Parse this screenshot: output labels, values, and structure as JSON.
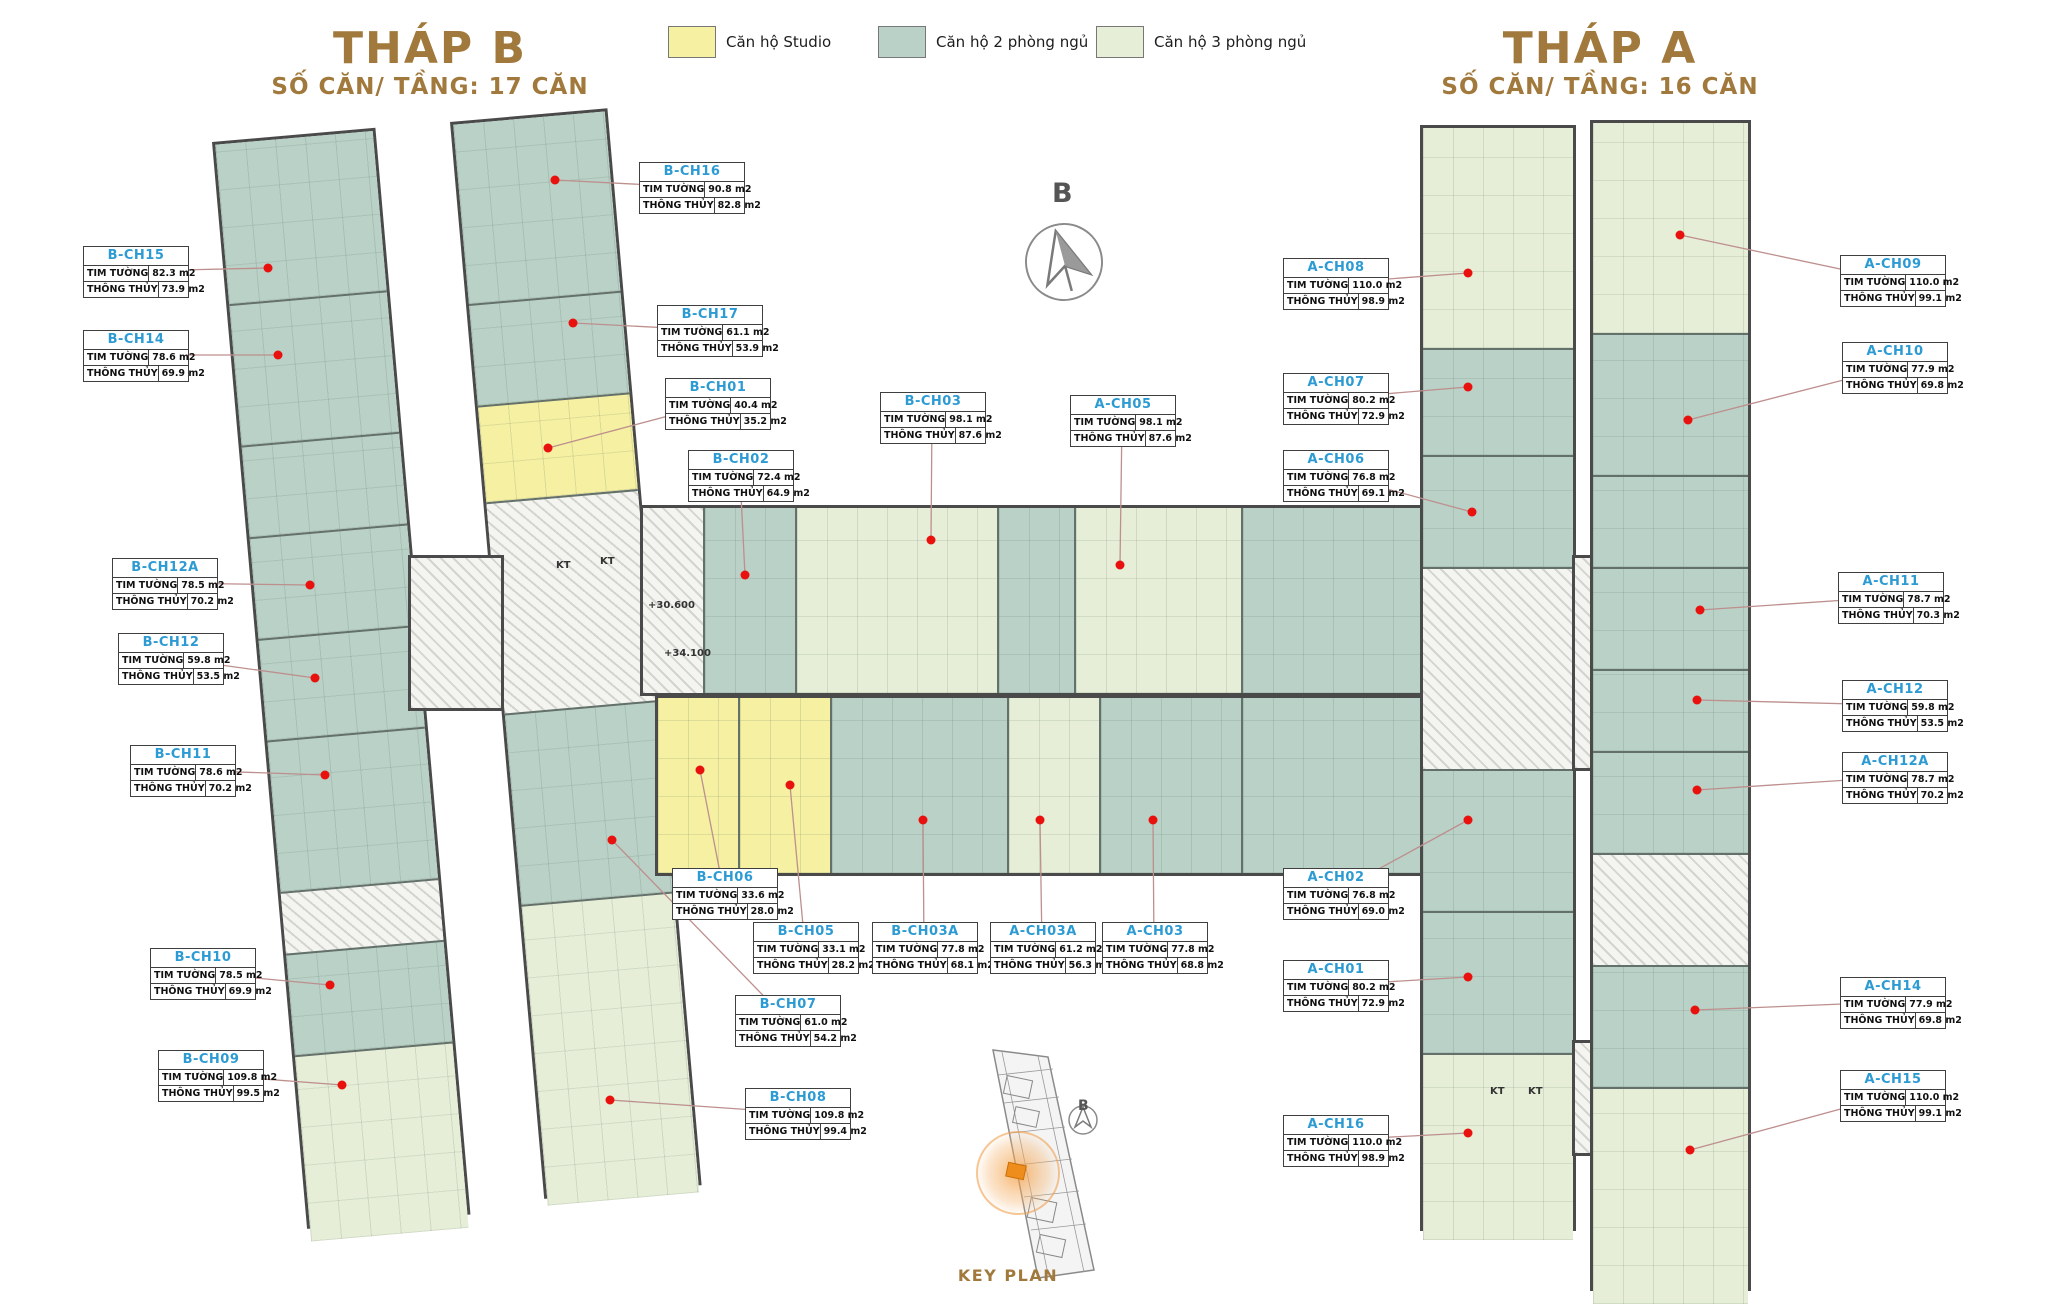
{
  "towers": {
    "b": {
      "title": "THÁP B",
      "subtitle": "SỐ CĂN/ TẦNG: 17 CĂN"
    },
    "a": {
      "title": "THÁP A",
      "subtitle": "SỐ CĂN/ TẦNG: 16 CĂN"
    }
  },
  "legend": [
    {
      "label": "Căn hộ Studio",
      "color": "#f5f0a2",
      "x": 668,
      "y": 26
    },
    {
      "label": "Căn hộ 2 phòng ngủ",
      "color": "#b9d1c6",
      "x": 878,
      "y": 26
    },
    {
      "label": "Căn hộ 3 phòng ngủ",
      "color": "#e6eed8",
      "x": 1096,
      "y": 26
    }
  ],
  "row_labels": {
    "tim_tuong": "TIM TƯỜNG",
    "thong_thuy": "THÔNG THỦY"
  },
  "compass": {
    "letter": "B"
  },
  "key_plan": {
    "label": "KEY PLAN",
    "compass_letter": "B"
  },
  "annotations": {
    "items": [
      {
        "text": "KT",
        "x": 556,
        "y": 560
      },
      {
        "text": "KT",
        "x": 600,
        "y": 556
      },
      {
        "text": "+30.600",
        "x": 648,
        "y": 600
      },
      {
        "text": "+34.100",
        "x": 664,
        "y": 648
      },
      {
        "text": "KT",
        "x": 1490,
        "y": 1086
      },
      {
        "text": "KT",
        "x": 1528,
        "y": 1086
      }
    ]
  },
  "units": [
    {
      "id": "B-CH15",
      "tim": "82.3 m2",
      "thong": "73.9 m2",
      "box": [
        83,
        246
      ],
      "dot": [
        268,
        268
      ]
    },
    {
      "id": "B-CH14",
      "tim": "78.6 m2",
      "thong": "69.9 m2",
      "box": [
        83,
        330
      ],
      "dot": [
        278,
        355
      ]
    },
    {
      "id": "B-CH12A",
      "tim": "78.5 m2",
      "thong": "70.2 m2",
      "box": [
        112,
        558
      ],
      "dot": [
        310,
        585
      ]
    },
    {
      "id": "B-CH12",
      "tim": "59.8 m2",
      "thong": "53.5 m2",
      "box": [
        118,
        633
      ],
      "dot": [
        315,
        678
      ]
    },
    {
      "id": "B-CH11",
      "tim": "78.6 m2",
      "thong": "70.2 m2",
      "box": [
        130,
        745
      ],
      "dot": [
        325,
        775
      ]
    },
    {
      "id": "B-CH10",
      "tim": "78.5 m2",
      "thong": "69.9 m2",
      "box": [
        150,
        948
      ],
      "dot": [
        330,
        985
      ]
    },
    {
      "id": "B-CH09",
      "tim": "109.8 m2",
      "thong": "99.5 m2",
      "box": [
        158,
        1050
      ],
      "dot": [
        342,
        1085
      ]
    },
    {
      "id": "B-CH16",
      "tim": "90.8 m2",
      "thong": "82.8 m2",
      "box": [
        639,
        162
      ],
      "dot": [
        555,
        180
      ]
    },
    {
      "id": "B-CH17",
      "tim": "61.1 m2",
      "thong": "53.9 m2",
      "box": [
        657,
        305
      ],
      "dot": [
        573,
        323
      ]
    },
    {
      "id": "B-CH01",
      "tim": "40.4 m2",
      "thong": "35.2 m2",
      "box": [
        665,
        378
      ],
      "dot": [
        548,
        448
      ]
    },
    {
      "id": "B-CH02",
      "tim": "72.4 m2",
      "thong": "64.9 m2",
      "box": [
        688,
        450
      ],
      "dot": [
        745,
        575
      ]
    },
    {
      "id": "B-CH03",
      "tim": "98.1 m2",
      "thong": "87.6 m2",
      "box": [
        880,
        392
      ],
      "dot": [
        931,
        540
      ]
    },
    {
      "id": "A-CH05",
      "tim": "98.1 m2",
      "thong": "87.6 m2",
      "box": [
        1070,
        395
      ],
      "dot": [
        1120,
        565
      ]
    },
    {
      "id": "B-CH06",
      "tim": "33.6 m2",
      "thong": "28.0 m2",
      "box": [
        672,
        868
      ],
      "dot": [
        700,
        770
      ]
    },
    {
      "id": "B-CH05",
      "tim": "33.1 m2",
      "thong": "28.2 m2",
      "box": [
        753,
        922
      ],
      "dot": [
        790,
        785
      ]
    },
    {
      "id": "B-CH03A",
      "tim": "77.8 m2",
      "thong": "68.1 m2",
      "box": [
        872,
        922
      ],
      "dot": [
        923,
        820
      ]
    },
    {
      "id": "A-CH03A",
      "tim": "61.2 m2",
      "thong": "56.3 m2",
      "box": [
        990,
        922
      ],
      "dot": [
        1040,
        820
      ]
    },
    {
      "id": "A-CH03",
      "tim": "77.8 m2",
      "thong": "68.8 m2",
      "box": [
        1102,
        922
      ],
      "dot": [
        1153,
        820
      ]
    },
    {
      "id": "B-CH07",
      "tim": "61.0 m2",
      "thong": "54.2 m2",
      "box": [
        735,
        995
      ],
      "dot": [
        612,
        840
      ]
    },
    {
      "id": "B-CH08",
      "tim": "109.8 m2",
      "thong": "99.4 m2",
      "box": [
        745,
        1088
      ],
      "dot": [
        610,
        1100
      ]
    },
    {
      "id": "A-CH08",
      "tim": "110.0 m2",
      "thong": "98.9 m2",
      "box": [
        1283,
        258
      ],
      "dot": [
        1468,
        273
      ]
    },
    {
      "id": "A-CH07",
      "tim": "80.2 m2",
      "thong": "72.9 m2",
      "box": [
        1283,
        373
      ],
      "dot": [
        1468,
        387
      ]
    },
    {
      "id": "A-CH06",
      "tim": "76.8 m2",
      "thong": "69.1 m2",
      "box": [
        1283,
        450
      ],
      "dot": [
        1472,
        512
      ]
    },
    {
      "id": "A-CH02",
      "tim": "76.8 m2",
      "thong": "69.0 m2",
      "box": [
        1283,
        868
      ],
      "dot": [
        1468,
        820
      ]
    },
    {
      "id": "A-CH01",
      "tim": "80.2 m2",
      "thong": "72.9 m2",
      "box": [
        1283,
        960
      ],
      "dot": [
        1468,
        977
      ]
    },
    {
      "id": "A-CH16",
      "tim": "110.0 m2",
      "thong": "98.9 m2",
      "box": [
        1283,
        1115
      ],
      "dot": [
        1468,
        1133
      ]
    },
    {
      "id": "A-CH09",
      "tim": "110.0 m2",
      "thong": "99.1 m2",
      "box": [
        1840,
        255
      ],
      "dot": [
        1680,
        235
      ]
    },
    {
      "id": "A-CH10",
      "tim": "77.9 m2",
      "thong": "69.8 m2",
      "box": [
        1842,
        342
      ],
      "dot": [
        1688,
        420
      ]
    },
    {
      "id": "A-CH11",
      "tim": "78.7 m2",
      "thong": "70.3 m2",
      "box": [
        1838,
        572
      ],
      "dot": [
        1700,
        610
      ]
    },
    {
      "id": "A-CH12",
      "tim": "59.8 m2",
      "thong": "53.5 m2",
      "box": [
        1842,
        680
      ],
      "dot": [
        1697,
        700
      ]
    },
    {
      "id": "A-CH12A",
      "tim": "78.7 m2",
      "thong": "70.2 m2",
      "box": [
        1842,
        752
      ],
      "dot": [
        1697,
        790
      ]
    },
    {
      "id": "A-CH14",
      "tim": "77.9 m2",
      "thong": "69.8 m2",
      "box": [
        1840,
        977
      ],
      "dot": [
        1695,
        1010
      ]
    },
    {
      "id": "A-CH15",
      "tim": "110.0 m2",
      "thong": "99.1 m2",
      "box": [
        1840,
        1070
      ],
      "dot": [
        1690,
        1150
      ]
    }
  ],
  "plan": {
    "leader_color": "#bd8f8e",
    "dot_color": "#e8110e",
    "wings": [
      {
        "name": "tower-b-left-wing",
        "x": 212,
        "y": 142,
        "dir": "v",
        "thick": 158,
        "rot": -5,
        "segments": [
          {
            "c": "unit2",
            "len": 160
          },
          {
            "c": "unit2",
            "len": 140
          },
          {
            "c": "unit2",
            "len": 90
          },
          {
            "c": "unit2",
            "len": 100
          },
          {
            "c": "unit2",
            "len": 100
          },
          {
            "c": "unit2",
            "len": 150
          },
          {
            "c": "core",
            "len": 60
          },
          {
            "c": "unit2",
            "len": 100
          },
          {
            "c": "unit3",
            "len": 185
          }
        ]
      },
      {
        "name": "tower-b-right-wing",
        "x": 450,
        "y": 122,
        "dir": "v",
        "thick": 152,
        "rot": -5,
        "segments": [
          {
            "c": "unit2",
            "len": 180
          },
          {
            "c": "unit2",
            "len": 100
          },
          {
            "c": "studio",
            "len": 95
          },
          {
            "c": "core",
            "len": 210
          },
          {
            "c": "unit2",
            "len": 190
          },
          {
            "c": "unit3",
            "len": 300
          }
        ]
      },
      {
        "name": "tower-b-core",
        "x": 408,
        "y": 555,
        "dir": "h",
        "thick": 150,
        "rot": 0,
        "segments": [
          {
            "c": "core",
            "len": 90
          }
        ]
      },
      {
        "name": "central-slab-upper",
        "x": 640,
        "y": 505,
        "dir": "h",
        "thick": 185,
        "rot": 0,
        "segments": [
          {
            "c": "core",
            "len": 60
          },
          {
            "c": "unit2",
            "len": 90
          },
          {
            "c": "unit3",
            "len": 200
          },
          {
            "c": "unit2",
            "len": 75
          },
          {
            "c": "unit3",
            "len": 165
          },
          {
            "c": "unit2",
            "len": 190
          }
        ]
      },
      {
        "name": "central-slab-lower",
        "x": 655,
        "y": 695,
        "dir": "h",
        "thick": 175,
        "rot": 0,
        "segments": [
          {
            "c": "studio",
            "len": 80
          },
          {
            "c": "studio",
            "len": 90
          },
          {
            "c": "unit2",
            "len": 175
          },
          {
            "c": "unit3",
            "len": 90
          },
          {
            "c": "unit2",
            "len": 140
          },
          {
            "c": "unit2",
            "len": 190
          }
        ]
      },
      {
        "name": "tower-a-left-block",
        "x": 1420,
        "y": 125,
        "dir": "v",
        "thick": 150,
        "rot": 0,
        "segments": [
          {
            "c": "unit3",
            "len": 220
          },
          {
            "c": "unit2",
            "len": 105
          },
          {
            "c": "unit2",
            "len": 110
          },
          {
            "c": "core",
            "len": 200
          },
          {
            "c": "unit2",
            "len": 140
          },
          {
            "c": "unit2",
            "len": 140
          },
          {
            "c": "unit3",
            "len": 185
          }
        ]
      },
      {
        "name": "tower-a-bridge",
        "x": 1572,
        "y": 555,
        "dir": "v",
        "thick": 16,
        "rot": 0,
        "segments": [
          {
            "c": "core",
            "len": 210
          }
        ]
      },
      {
        "name": "tower-a-bridge-lower",
        "x": 1572,
        "y": 1040,
        "dir": "v",
        "thick": 16,
        "rot": 0,
        "segments": [
          {
            "c": "core",
            "len": 110
          }
        ]
      },
      {
        "name": "tower-a-right-block",
        "x": 1590,
        "y": 120,
        "dir": "v",
        "thick": 155,
        "rot": 0,
        "segments": [
          {
            "c": "unit3",
            "len": 210
          },
          {
            "c": "unit2",
            "len": 140
          },
          {
            "c": "unit2",
            "len": 90
          },
          {
            "c": "unit2",
            "len": 100
          },
          {
            "c": "unit2",
            "len": 80
          },
          {
            "c": "unit2",
            "len": 100
          },
          {
            "c": "core",
            "len": 110
          },
          {
            "c": "unit2",
            "len": 120
          },
          {
            "c": "unit3",
            "len": 215
          }
        ]
      }
    ]
  }
}
